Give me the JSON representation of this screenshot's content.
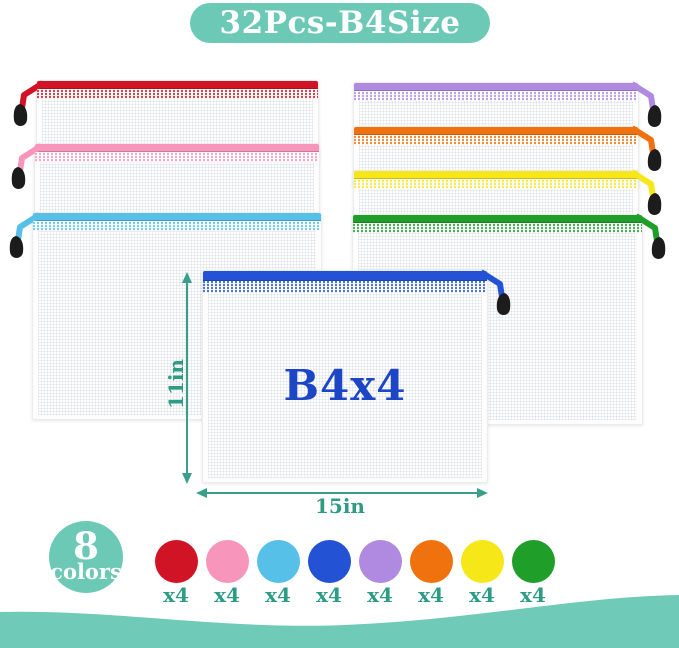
{
  "banner": {
    "title": "32Pcs-B4Size"
  },
  "theme": {
    "teal": "#6cc9b6",
    "teal_dark": "#2e9b85",
    "arrow": "#38a08a",
    "wave": "#6fcab7",
    "center_label": "#1c46c6",
    "pull": "#1c1c1c"
  },
  "palette": {
    "red": "#d01426",
    "pink": "#f795bb",
    "sky": "#57c0e8",
    "royal": "#2353d4",
    "purple": "#b08ae0",
    "orange": "#f0720e",
    "yellow": "#f6e718",
    "green": "#1f9e2a"
  },
  "pouches": {
    "left": [
      "red",
      "pink",
      "sky"
    ],
    "right": [
      "purple",
      "orange",
      "yellow",
      "green"
    ],
    "center": {
      "color": "royal",
      "label": "B4x4"
    }
  },
  "dimensions": {
    "height_label": "11in",
    "width_label": "15in"
  },
  "badge": {
    "count": "8",
    "word": "colors"
  },
  "swatches": [
    {
      "color": "red",
      "label": "x4"
    },
    {
      "color": "pink",
      "label": "x4"
    },
    {
      "color": "sky",
      "label": "x4"
    },
    {
      "color": "royal",
      "label": "x4"
    },
    {
      "color": "purple",
      "label": "x4"
    },
    {
      "color": "orange",
      "label": "x4"
    },
    {
      "color": "yellow",
      "label": "x4"
    },
    {
      "color": "green",
      "label": "x4"
    }
  ]
}
